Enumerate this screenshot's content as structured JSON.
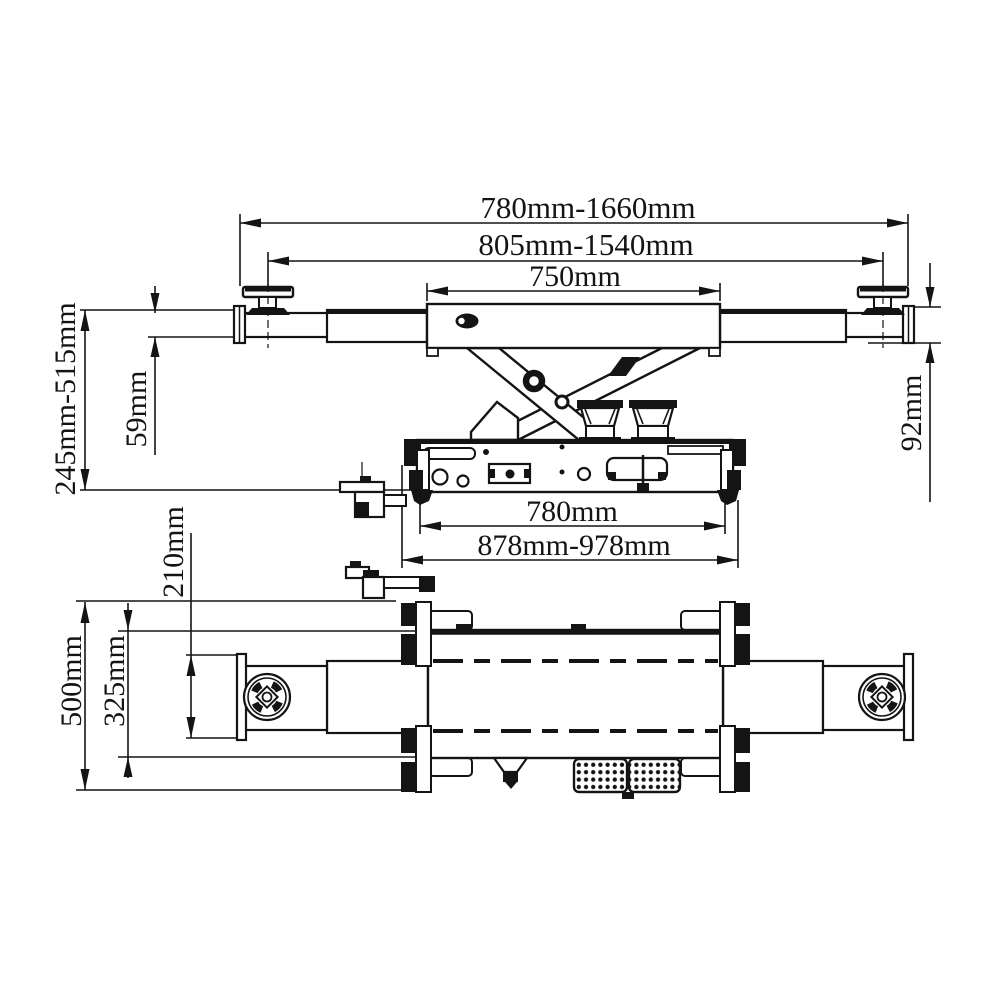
{
  "figure": {
    "type": "engineering-line-drawing",
    "subject": "scissor rolling jack, two orthographic views with dimensions",
    "line_color": "#141414",
    "background": "#ffffff"
  },
  "dimensions": {
    "span_outer": "780mm-1660mm",
    "span_pad_centers": "805mm-1540mm",
    "center_section": "750mm",
    "height_range": "245mm-515mm",
    "arm_profile": "59mm",
    "arm_end": "92mm",
    "frame_inner": "780mm",
    "frame_overall": "878mm-978mm",
    "pad_offset": "210mm",
    "body_width": "325mm",
    "overall_width": "500mm"
  }
}
